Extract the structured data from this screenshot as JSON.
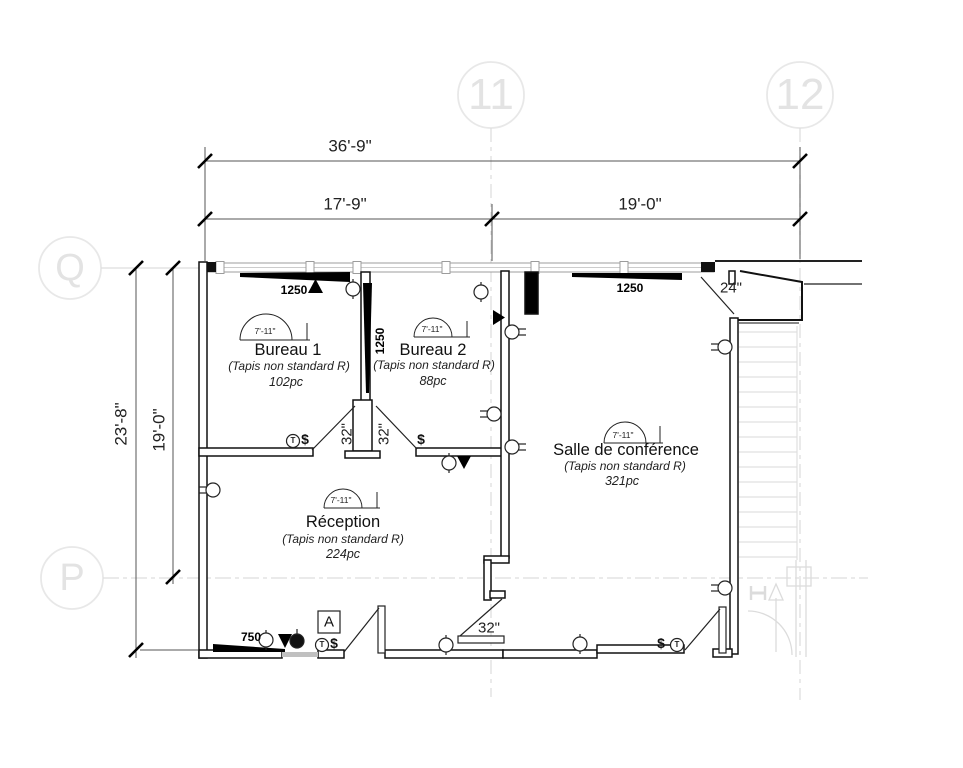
{
  "grid_bubbles": {
    "col1": "11",
    "col2": "12",
    "rowQ": "Q",
    "rowP": "P"
  },
  "dimensions": {
    "overall_width": "36'-9\"",
    "width_left": "17'-9\"",
    "width_right": "19'-0\"",
    "overall_height": "23'-8\"",
    "height_inner": "19'-0\"",
    "entry_door": "24\"",
    "door_bureau1": "32\"",
    "door_bureau2": "32\"",
    "door_reception": "32\""
  },
  "rooms": {
    "bureau1": {
      "name": "Bureau 1",
      "note": "(Tapis non standard R)",
      "area": "102pc",
      "ceiling": "7'-11\""
    },
    "bureau2": {
      "name": "Bureau 2",
      "note": "(Tapis non standard R)",
      "area": "88pc",
      "ceiling": "7'-11\""
    },
    "conference": {
      "name": "Salle de conférence",
      "note": "(Tapis non standard R)",
      "area": "321pc",
      "ceiling": "7'-11\""
    },
    "reception": {
      "name": "Réception",
      "note": "(Tapis non standard R)",
      "area": "224pc",
      "ceiling": "7'-11\""
    }
  },
  "beams": {
    "bureau1": "1250",
    "bureau2": "1250",
    "conference": "1250",
    "south": "750"
  },
  "symbols": {
    "thermostat": "T",
    "switch": "$",
    "section_marker": "A"
  }
}
